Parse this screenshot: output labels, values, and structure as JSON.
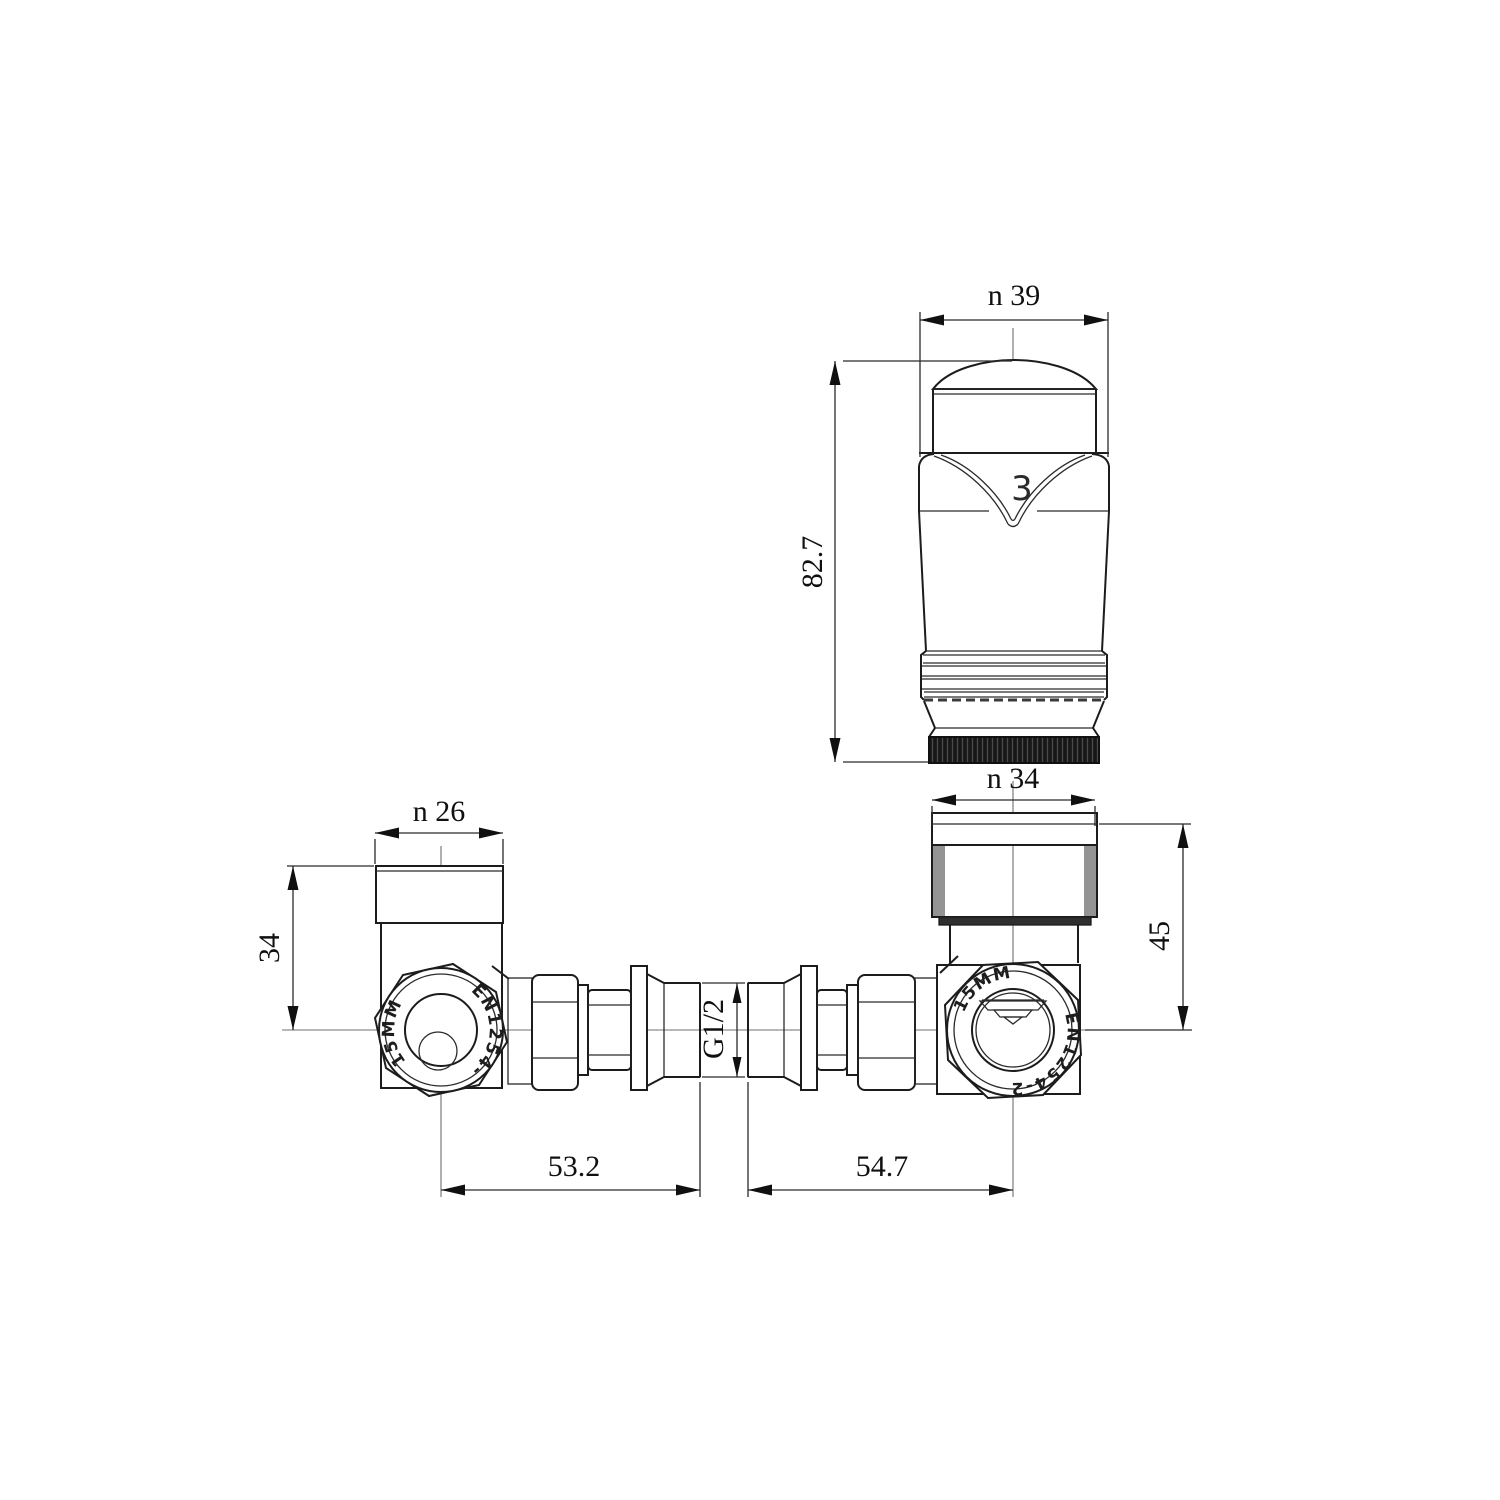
{
  "drawing": {
    "head": {
      "diameter_label": "n 39",
      "height_label": "82.7",
      "setting_number": "3"
    },
    "trv_valve": {
      "cap_diameter_label": "n 34",
      "height_label": "45",
      "length_label": "54.7",
      "port_size_label": "15MM",
      "standard_label": "EN1254-2"
    },
    "lockshield_valve": {
      "cap_diameter_label": "n 26",
      "height_label": "34",
      "length_label": "53.2",
      "port_size_label": "15MM",
      "standard_label": "EN1254-2"
    },
    "tail_piece": {
      "thread_label": "G1/2"
    }
  },
  "colors": {
    "line": "#1c1c1c",
    "centerline": "#707070",
    "knurl_dark": "#161616",
    "background": "#ffffff"
  }
}
